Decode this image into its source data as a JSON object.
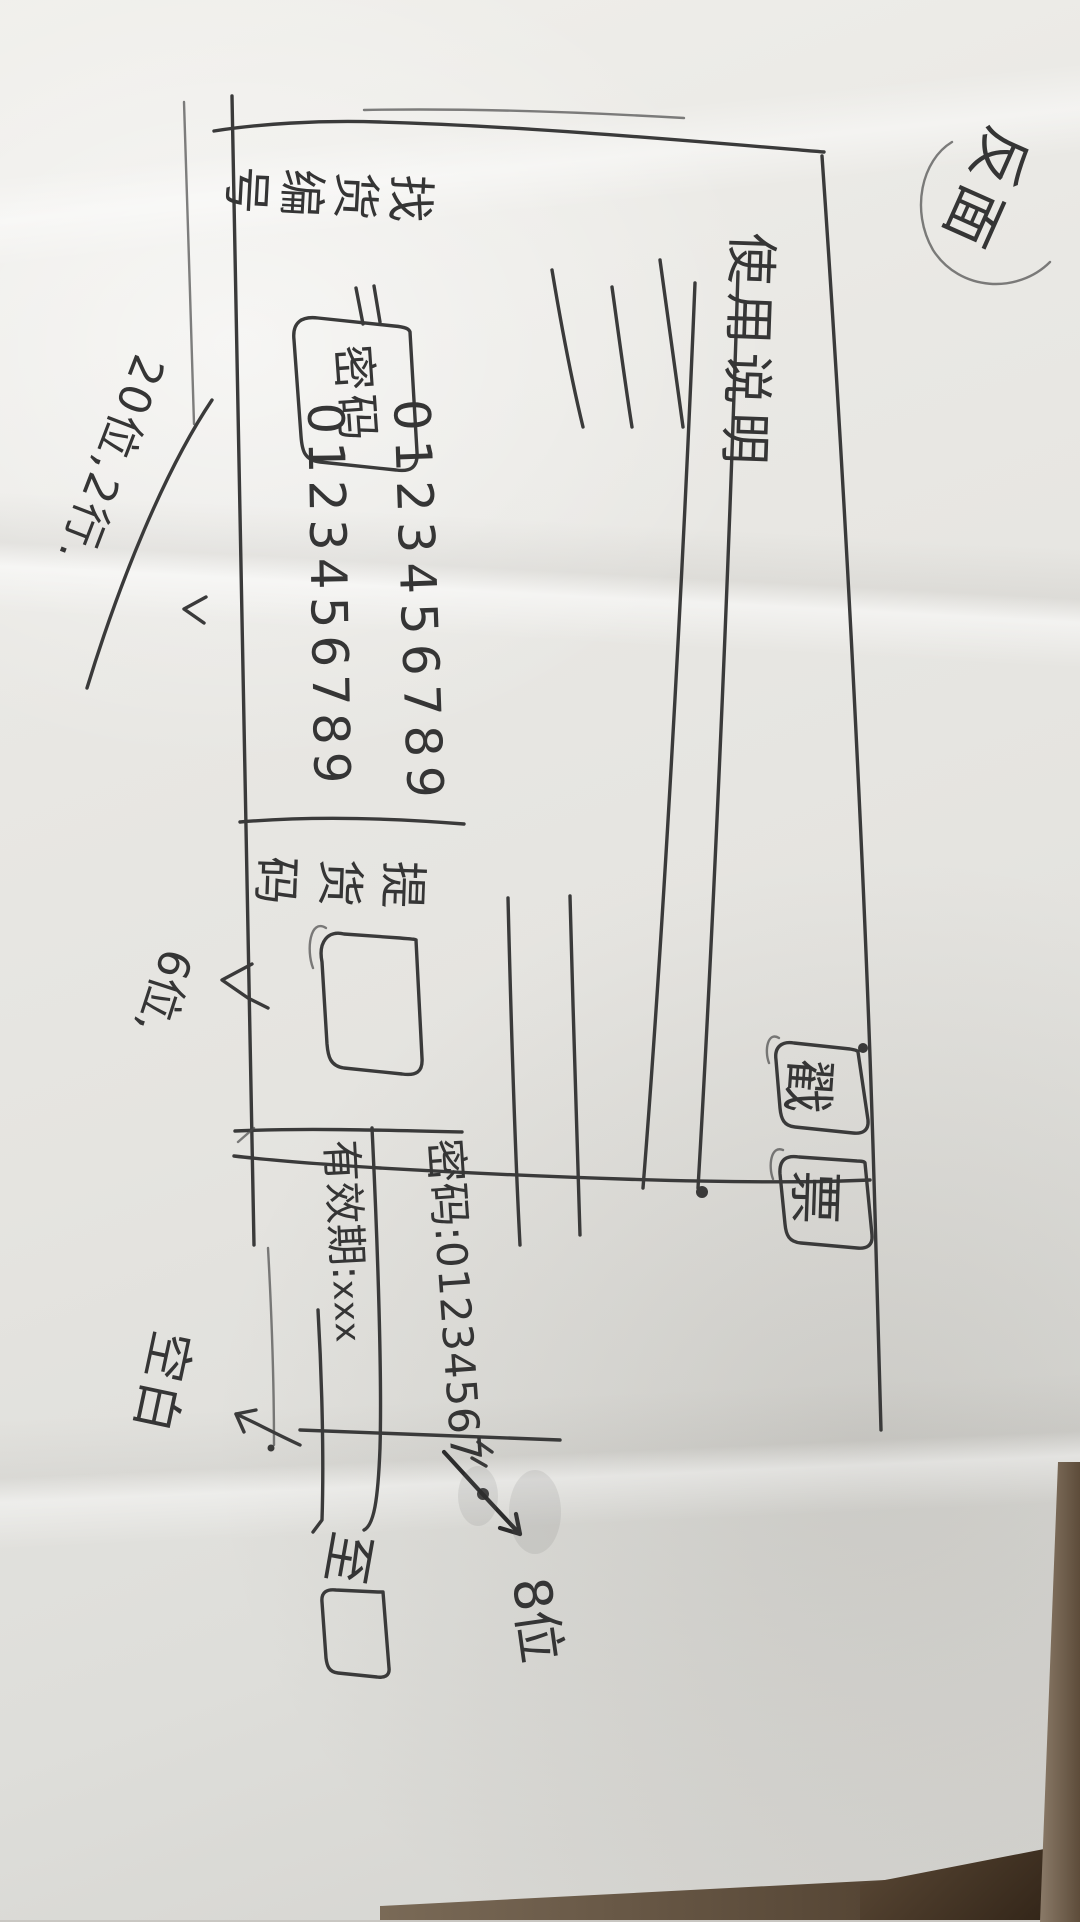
{
  "sketch": {
    "corner_label": "反面",
    "card": {
      "title": "使用说明",
      "stamp_box_1": "戳",
      "stamp_box_2": "票",
      "row_find": {
        "label_vertical": "找货编号",
        "password_box": "密码",
        "digits_row_1": "0123456789",
        "digits_row_2": "0123456789"
      },
      "row_pickup": {
        "label_vertical": "提货码"
      },
      "panel": {
        "password_label": "密码:",
        "password_value": "01234567",
        "validity_label": "有效期:",
        "validity_value": "xxx",
        "to_label": "至"
      }
    },
    "annotations": {
      "digits_note": "20位,2行.",
      "code_note": "6位,",
      "password_note": "8位",
      "blank_note": "空白"
    }
  }
}
